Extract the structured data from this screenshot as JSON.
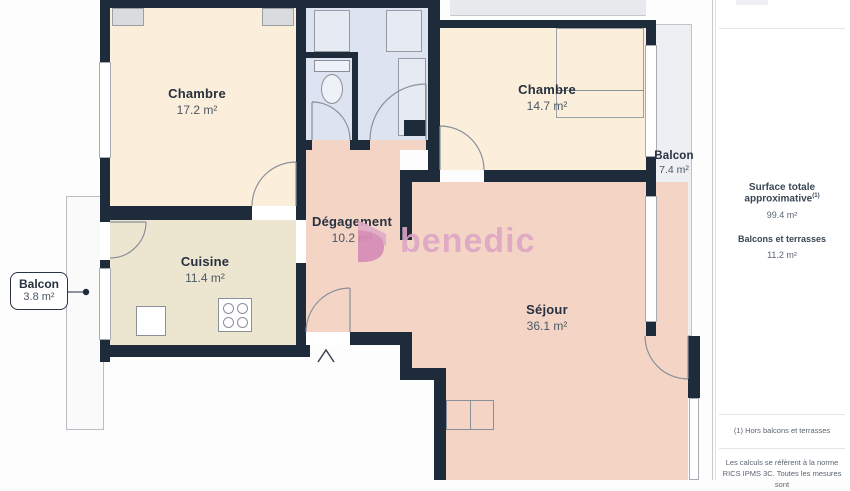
{
  "rooms": {
    "chambre1": {
      "label": "Chambre",
      "area": "17.2 m²"
    },
    "chambre2": {
      "label": "Chambre",
      "area": "14.7 m²"
    },
    "degagement": {
      "label": "Dégagement",
      "area": "10.2 m²"
    },
    "cuisine": {
      "label": "Cuisine",
      "area": "11.4 m²"
    },
    "sejour": {
      "label": "Séjour",
      "area": "36.1 m²"
    },
    "balcon_droit": {
      "label": "Balcon",
      "area": "7.4 m²"
    },
    "balcon_gauche": {
      "label": "Balcon",
      "area": "3.8 m²"
    }
  },
  "watermark": {
    "text": "benedic",
    "color": "#dca6c4"
  },
  "sidebar": {
    "total_label": "Surface totale approximative",
    "total_sup": "(1)",
    "total_value": "99.4 m²",
    "balconies_label": "Balcons et terrasses",
    "balconies_value": "11.2 m²",
    "footnote1": "(1) Hors balcons et terrasses",
    "footnote2": "Les calculs se réfèrent à la norme RICS IPMS 3C. Toutes les mesures sont"
  },
  "colors": {
    "wall": "#1d2b3a",
    "bedroom_floor": "#fbeeda",
    "kitchen_floor": "#ece6d0",
    "hall_floor": "#dde3f0",
    "living_floor": "#f4d5c5",
    "balcony_floor": "#edeff2"
  }
}
